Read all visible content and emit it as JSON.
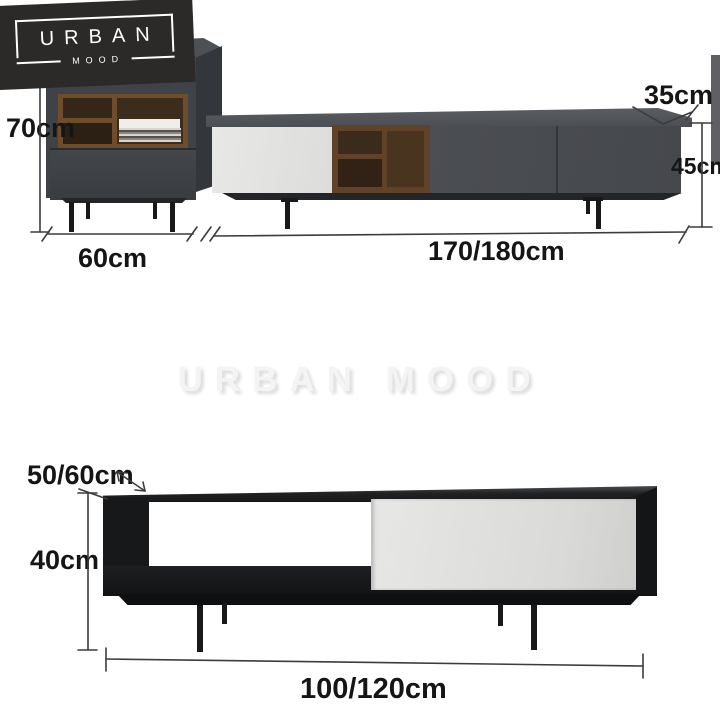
{
  "brand": {
    "primary": "URBAN",
    "secondary": "MOOD"
  },
  "watermark": {
    "text": "URBAN MOOD"
  },
  "annotations": {
    "cabinet": {
      "height": "70cm",
      "width": "60cm"
    },
    "console": {
      "depth": "35cm",
      "height": "45cm",
      "width": "170/180cm"
    },
    "table": {
      "depth": "50/60cm",
      "height": "40cm",
      "width": "100/120cm"
    }
  },
  "colors": {
    "logo_bg": "#2b2a28",
    "cabinet_grey": "#3f4347",
    "console_grey": "#4b4e53",
    "door_white": "#e4e4e3",
    "wood": "#5f4227",
    "table_black": "#161718",
    "dimension_line": "#3c3c3c",
    "watermark_grey": "#f4f4f4"
  }
}
